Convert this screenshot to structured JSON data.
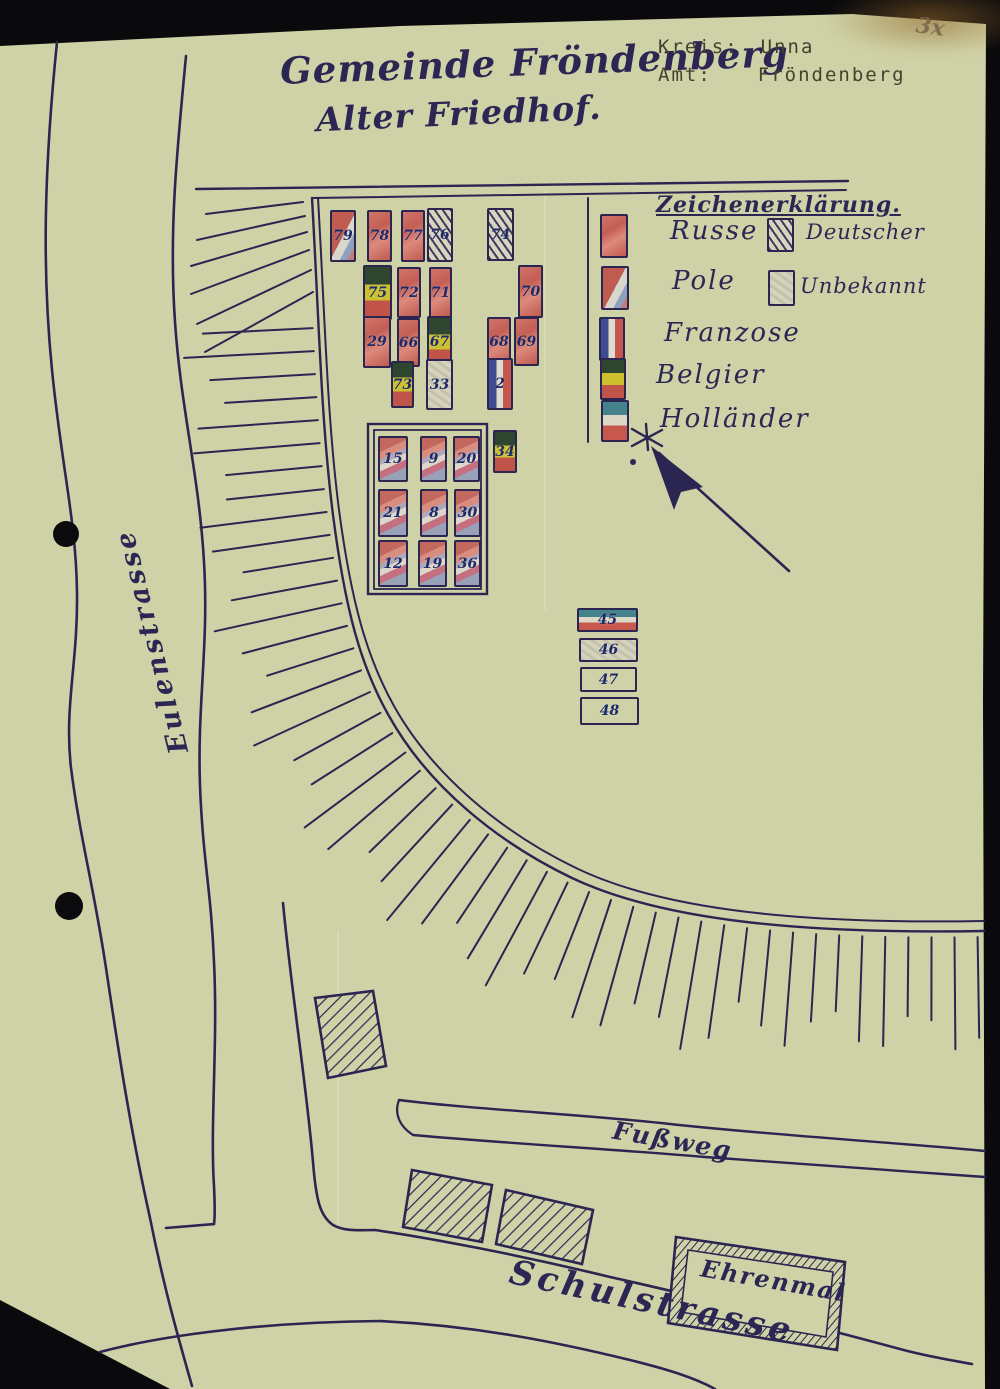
{
  "page": {
    "title1": "Gemeinde Fröndenberg",
    "title2": "Alter Friedhof.",
    "kreis_label": "Kreis:",
    "kreis_value": "Unna",
    "amt_label": "Amt:",
    "amt_value": "Fröndenberg",
    "corner_note": "3x"
  },
  "legend": {
    "heading": "Zeichenerklärung.",
    "entries": [
      {
        "label": "Russe",
        "type": "russe"
      },
      {
        "label": "Pole",
        "type": "pole"
      },
      {
        "label": "Franzose",
        "type": "franzose"
      },
      {
        "label": "Belgier",
        "type": "belgier"
      },
      {
        "label": "Holländer",
        "type": "hollaender"
      },
      {
        "label": "Deutscher",
        "type": "deutscher"
      },
      {
        "label": "Unbekannt",
        "type": "unbekannt"
      }
    ]
  },
  "streets": {
    "west": "Eulenstrasse",
    "footpath": "Fußweg",
    "south": "Schulstrasse",
    "memorial": "Ehrenmal"
  },
  "graves": [
    {
      "label": "79",
      "type": "pole",
      "x": 330,
      "y": 210,
      "w": 26,
      "h": 52
    },
    {
      "label": "78",
      "type": "russe",
      "x": 367,
      "y": 210,
      "w": 25,
      "h": 52
    },
    {
      "label": "77",
      "type": "russe",
      "x": 401,
      "y": 210,
      "w": 24,
      "h": 52
    },
    {
      "label": "76",
      "type": "deutscher",
      "x": 427,
      "y": 208,
      "w": 26,
      "h": 54
    },
    {
      "label": "74",
      "type": "deutscher",
      "x": 487,
      "y": 208,
      "w": 27,
      "h": 53
    },
    {
      "label": "75",
      "type": "belgier",
      "x": 363,
      "y": 265,
      "w": 29,
      "h": 55
    },
    {
      "label": "72",
      "type": "russe",
      "x": 397,
      "y": 267,
      "w": 24,
      "h": 51
    },
    {
      "label": "71",
      "type": "russe",
      "x": 429,
      "y": 267,
      "w": 23,
      "h": 51
    },
    {
      "label": "70",
      "type": "russe",
      "x": 518,
      "y": 265,
      "w": 25,
      "h": 53
    },
    {
      "label": "29",
      "type": "russe",
      "x": 363,
      "y": 316,
      "w": 28,
      "h": 52
    },
    {
      "label": "66",
      "type": "russe",
      "x": 397,
      "y": 318,
      "w": 23,
      "h": 49
    },
    {
      "label": "67",
      "type": "belgier",
      "x": 427,
      "y": 316,
      "w": 25,
      "h": 52
    },
    {
      "label": "68",
      "type": "russe",
      "x": 487,
      "y": 317,
      "w": 24,
      "h": 49
    },
    {
      "label": "69",
      "type": "russe",
      "x": 514,
      "y": 317,
      "w": 25,
      "h": 49
    },
    {
      "label": "73",
      "type": "belgier",
      "x": 391,
      "y": 361,
      "w": 23,
      "h": 47
    },
    {
      "label": "33",
      "type": "unbekannt",
      "x": 426,
      "y": 359,
      "w": 27,
      "h": 51
    },
    {
      "label": "2",
      "type": "franzose",
      "x": 487,
      "y": 358,
      "w": 26,
      "h": 52
    },
    {
      "label": "15",
      "type": "pole2",
      "x": 378,
      "y": 436,
      "w": 30,
      "h": 46
    },
    {
      "label": "9",
      "type": "pole2",
      "x": 420,
      "y": 436,
      "w": 27,
      "h": 46
    },
    {
      "label": "20",
      "type": "pole2",
      "x": 453,
      "y": 436,
      "w": 27,
      "h": 46
    },
    {
      "label": "21",
      "type": "pole2",
      "x": 378,
      "y": 489,
      "w": 30,
      "h": 48
    },
    {
      "label": "8",
      "type": "pole2",
      "x": 420,
      "y": 489,
      "w": 28,
      "h": 48
    },
    {
      "label": "30",
      "type": "pole2",
      "x": 454,
      "y": 489,
      "w": 27,
      "h": 48
    },
    {
      "label": "12",
      "type": "pole2",
      "x": 378,
      "y": 540,
      "w": 30,
      "h": 47
    },
    {
      "label": "19",
      "type": "pole2",
      "x": 418,
      "y": 540,
      "w": 29,
      "h": 47
    },
    {
      "label": "36",
      "type": "pole2",
      "x": 454,
      "y": 540,
      "w": 27,
      "h": 47
    },
    {
      "label": "34",
      "type": "belgier",
      "x": 493,
      "y": 430,
      "w": 24,
      "h": 43
    },
    {
      "label": "45",
      "type": "hollaender",
      "x": 577,
      "y": 608,
      "w": 61,
      "h": 24
    },
    {
      "label": "46",
      "type": "unbekannt",
      "x": 579,
      "y": 638,
      "w": 59,
      "h": 24
    },
    {
      "label": "47",
      "type": "plain",
      "x": 580,
      "y": 667,
      "w": 57,
      "h": 25
    },
    {
      "label": "48",
      "type": "plain",
      "x": 580,
      "y": 697,
      "w": 59,
      "h": 28
    }
  ],
  "colors": {
    "paper": "#cfd2a6",
    "ink": "#2b2552",
    "red_crayon": "#c86a60",
    "typed_ink": "#45412f"
  }
}
